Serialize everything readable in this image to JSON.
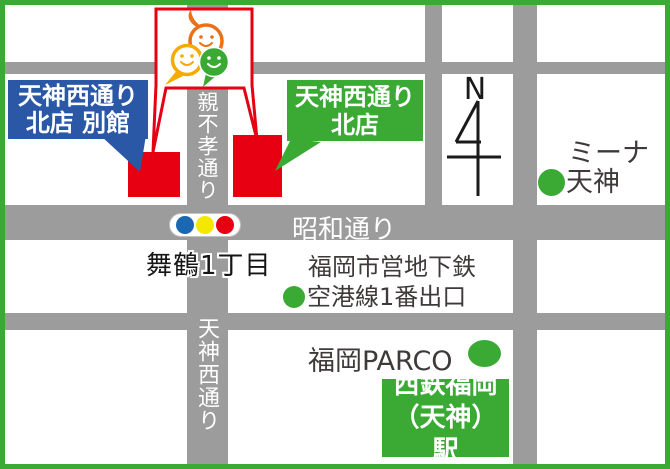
{
  "map_title": "store access map",
  "colors": {
    "frame_green": "#3aaa35",
    "road_gray": "#9c9c9c",
    "store_red": "#e60012",
    "callout_blue": "#2b57a7",
    "callout_green": "#3aaa35",
    "flag_red": "#e50012",
    "traffic_blue": "#1a67b3",
    "traffic_yellow": "#f4e800",
    "traffic_red": "#e60012",
    "text_dark": "#3e3a39",
    "logo_orange": "#e97117",
    "logo_yellow": "#f6ab00",
    "logo_green": "#3aaa35"
  },
  "stores": {
    "annex": {
      "line1": "天神西通り",
      "line2": "北店 別館"
    },
    "main": {
      "line1": "天神西通り",
      "line2": "北店"
    }
  },
  "roads": {
    "oyafuko": "親不孝通り",
    "showa": "昭和通り",
    "tenjin_nishi": "天神西通り"
  },
  "places": {
    "maizuru": "舞鶴1丁目",
    "subway_line1": "福岡市営地下鉄",
    "subway_line2": "空港線1番出口",
    "parco": "福岡PARCO",
    "mina_line1": "ミーナ",
    "mina_line2": "天神",
    "station_line1": "西鉄福岡",
    "station_line2": "（天神）駅"
  },
  "compass": {
    "label": "N"
  }
}
